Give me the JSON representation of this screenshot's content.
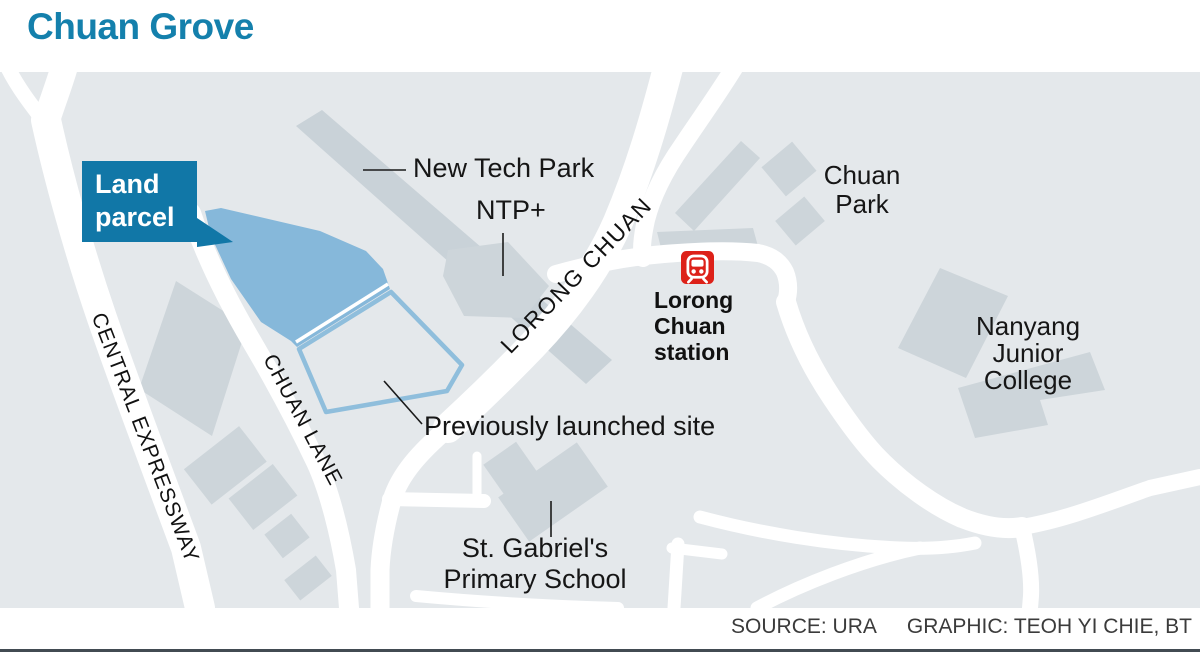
{
  "title": "Chuan Grove",
  "colors": {
    "accent_blue": "#1480AC",
    "label_box_blue": "#1177A7",
    "parcel_fill": "#86B8DA",
    "parcel_outline": "#8FBEDC",
    "map_background": "#E4E8EB",
    "building_gray": "#CDD5DA",
    "road_white": "#FFFFFF",
    "mrt_red": "#DD2119",
    "footer_rule": "#424B52"
  },
  "map": {
    "land_parcel_label": {
      "lines": [
        "Land",
        "parcel"
      ]
    },
    "road_labels": {
      "central_expressway": "CENTRAL EXPRESSWAY",
      "chuan_lane": "CHUAN LANE",
      "lorong_chuan": "LORONG CHUAN"
    },
    "places": {
      "new_tech_park": "New Tech Park",
      "ntp_plus": "NTP+",
      "chuan_park": {
        "lines": [
          "Chuan",
          "Park"
        ]
      },
      "station": {
        "lines": [
          "Lorong",
          "Chuan",
          "station"
        ]
      },
      "nanyang_jc": {
        "lines": [
          "Nanyang",
          "Junior",
          "College"
        ]
      },
      "previously_launched": "Previously launched site",
      "st_gabriels": {
        "lines": [
          "St. Gabriel's",
          "Primary School"
        ]
      }
    },
    "icons": {
      "mrt_station": "train-in-rounded-square"
    }
  },
  "footer": {
    "source": "SOURCE: URA",
    "graphic": "GRAPHIC: TEOH YI CHIE, BT"
  }
}
